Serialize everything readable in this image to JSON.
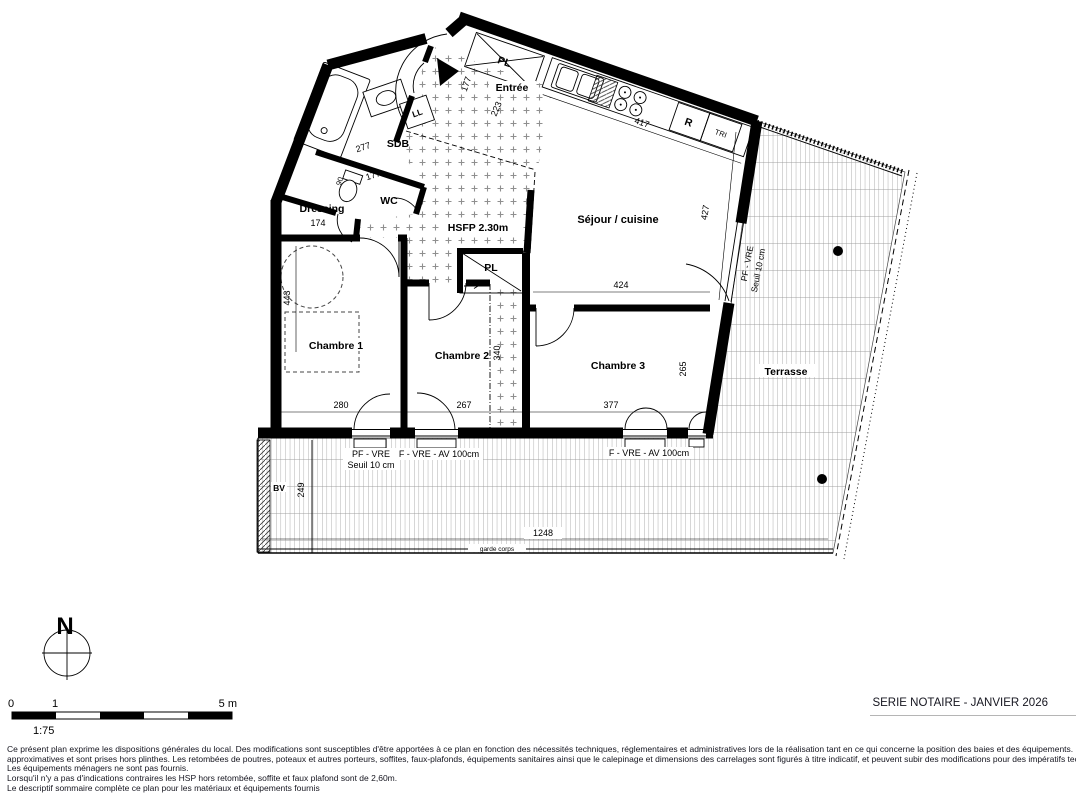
{
  "sheet": {
    "title": "SERIE NOTAIRE - JANVIER 2026",
    "scale_ratio": "1:75",
    "scale_ticks": {
      "zero": "0",
      "one": "1",
      "five": "5 m"
    },
    "north": "N"
  },
  "rooms": {
    "entree": "Entrée",
    "sdb": "SDB",
    "wc": "WC",
    "dressing": "Dressing",
    "sejour_cuisine": "Séjour / cuisine",
    "chambre1": "Chambre 1",
    "chambre2": "Chambre 2",
    "chambre3": "Chambre 3",
    "terrasse": "Terrasse",
    "hsfp": "HSFP 2.30m",
    "placard_entree": "PL",
    "placard_couloir": "PL",
    "lave_linge": "LL",
    "refrigerateur": "R",
    "tri": "TRI",
    "bv": "BV"
  },
  "dims": {
    "entree_177": "177",
    "entree_223": "223",
    "cuisine_417": "417",
    "sdb_277": "277",
    "wc_177": "177",
    "wc_90": "90",
    "dressing_174": "174",
    "sejour_424": "424",
    "sejour_427": "427",
    "chambre1_443": "443",
    "chambre1_280": "280",
    "chambre2_267": "267",
    "chambre2_340": "340",
    "chambre3_377": "377",
    "chambre3_265": "265",
    "terrasse_1248": "1248",
    "terrasse_249": "249"
  },
  "openings": {
    "right_pf_vre": "PF - VRE",
    "right_seuil": "Seuil 10 cm",
    "bottom_pf_vre": "PF - VRE",
    "bottom_seuil": "Seuil 10 cm",
    "bottom_f_vre_1": "F - VRE - AV 100cm",
    "bottom_f_vre_2": "F - VRE - AV 100cm",
    "garde_corps": "garde corps"
  },
  "legal": {
    "line1": "Ce présent plan exprime les dispositions générales du local. Des modifications sont susceptibles d'être apportées à ce plan en fonction des nécessités techniques, réglementaires et administratives lors de la réalisation tant en ce qui concerne la position des baies et des équipements. Les surfaces sont",
    "line2": "approximatives et sont prises hors plinthes. Les retombées de poutres, poteaux et autres porteurs, soffites, faux-plafonds, équipements sanitaires ainsi que le calepinage et dimensions des carrelages sont figurés à titre indicatif, et peuvent subir des modifications pour des impératifs techniques.",
    "line3": "Les équipements ménagers ne sont pas fournis.",
    "line4": "Lorsqu'il n'y a pas d'indications contraires les HSP hors retombée, soffite et faux plafond sont de 2,60m.",
    "line5": "Le descriptif sommaire complète ce plan pour les matériaux et équipements fournis"
  }
}
